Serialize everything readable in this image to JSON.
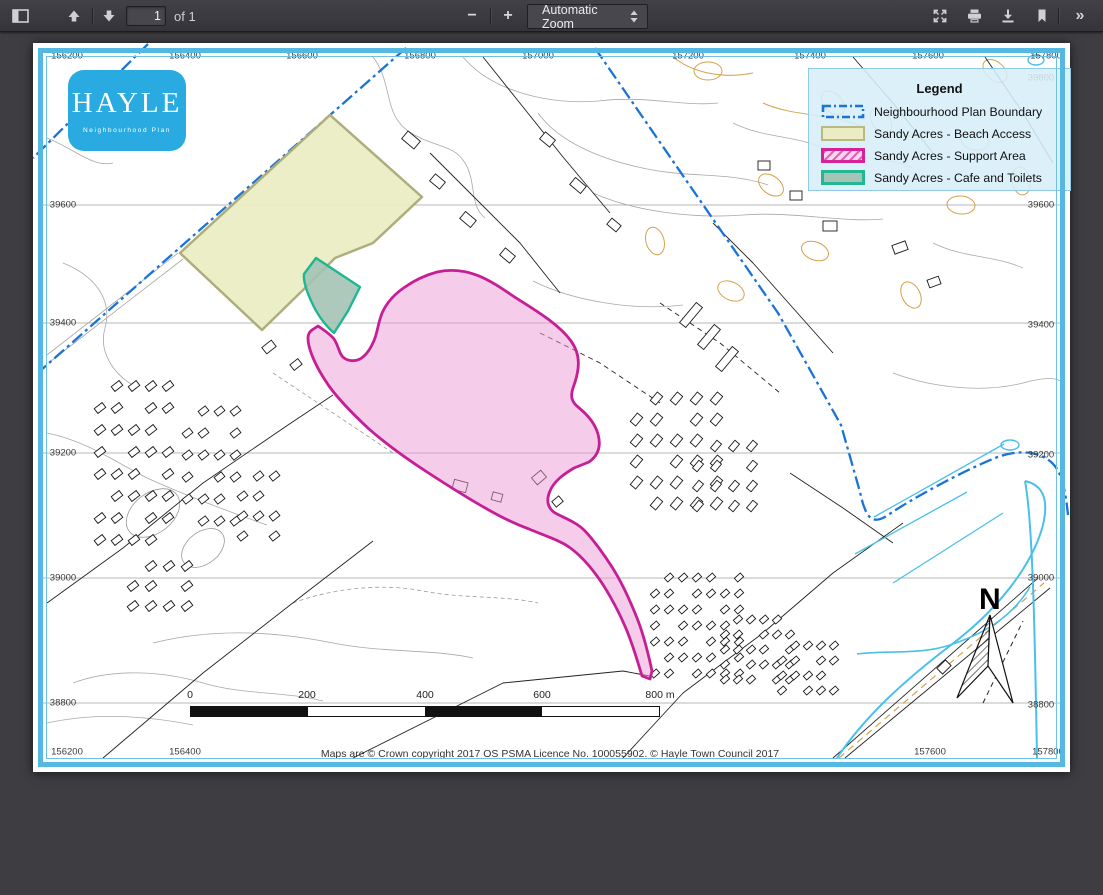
{
  "toolbar": {
    "page_value": "1",
    "of_label": "of 1",
    "zoom_label": "Automatic Zoom",
    "minus_sign": "−",
    "plus_sign": "+",
    "more_sign": "»"
  },
  "map": {
    "logo": {
      "title": "HAYLE",
      "subtitle": "Neighbourhood Plan"
    },
    "legend": {
      "title": "Legend",
      "items": [
        {
          "label": "Neighbourhood Plan Boundary",
          "swatch": "blue-dash-dot-outline"
        },
        {
          "label": "Sandy Acres - Beach Access",
          "swatch": "pale-yellow-fill"
        },
        {
          "label": "Sandy Acres - Support Area",
          "swatch": "pink-hatch-fill"
        },
        {
          "label": "Sandy Acres - Cafe and Toilets",
          "swatch": "grey-green-fill"
        }
      ]
    },
    "north_label": "N",
    "scalebar": {
      "labels": [
        "0",
        "200",
        "400",
        "600",
        "800 m"
      ]
    },
    "copyright": "Maps are © Crown copyright 2017 OS PSMA Licence No. 100055902. © Hayle Town Council 2017",
    "grid": {
      "top": [
        "156200",
        "156400",
        "156600",
        "156800",
        "157000",
        "157200",
        "157400",
        "157600",
        "157800"
      ],
      "bottom": [
        "156200",
        "156400",
        "157600",
        "157800"
      ],
      "left": [
        "39600",
        "39400",
        "39200",
        "39000",
        "38800"
      ],
      "right": [
        "39800",
        "39600",
        "39400",
        "39200",
        "39000",
        "38800"
      ]
    },
    "colors": {
      "boundary_blue": "#1a73d6",
      "beach_fill": "#eaedc3",
      "beach_border": "#aeae7c",
      "support_fill": "#ec9ad4",
      "support_border": "#c61f96",
      "cafe_fill": "#a3c3b5",
      "cafe_border": "#1fb691",
      "legend_bg": "#d6eef8",
      "logo_blue": "#29abe2",
      "water_cyan": "#49c0ea",
      "contour_tan": "#d2a24c"
    }
  }
}
